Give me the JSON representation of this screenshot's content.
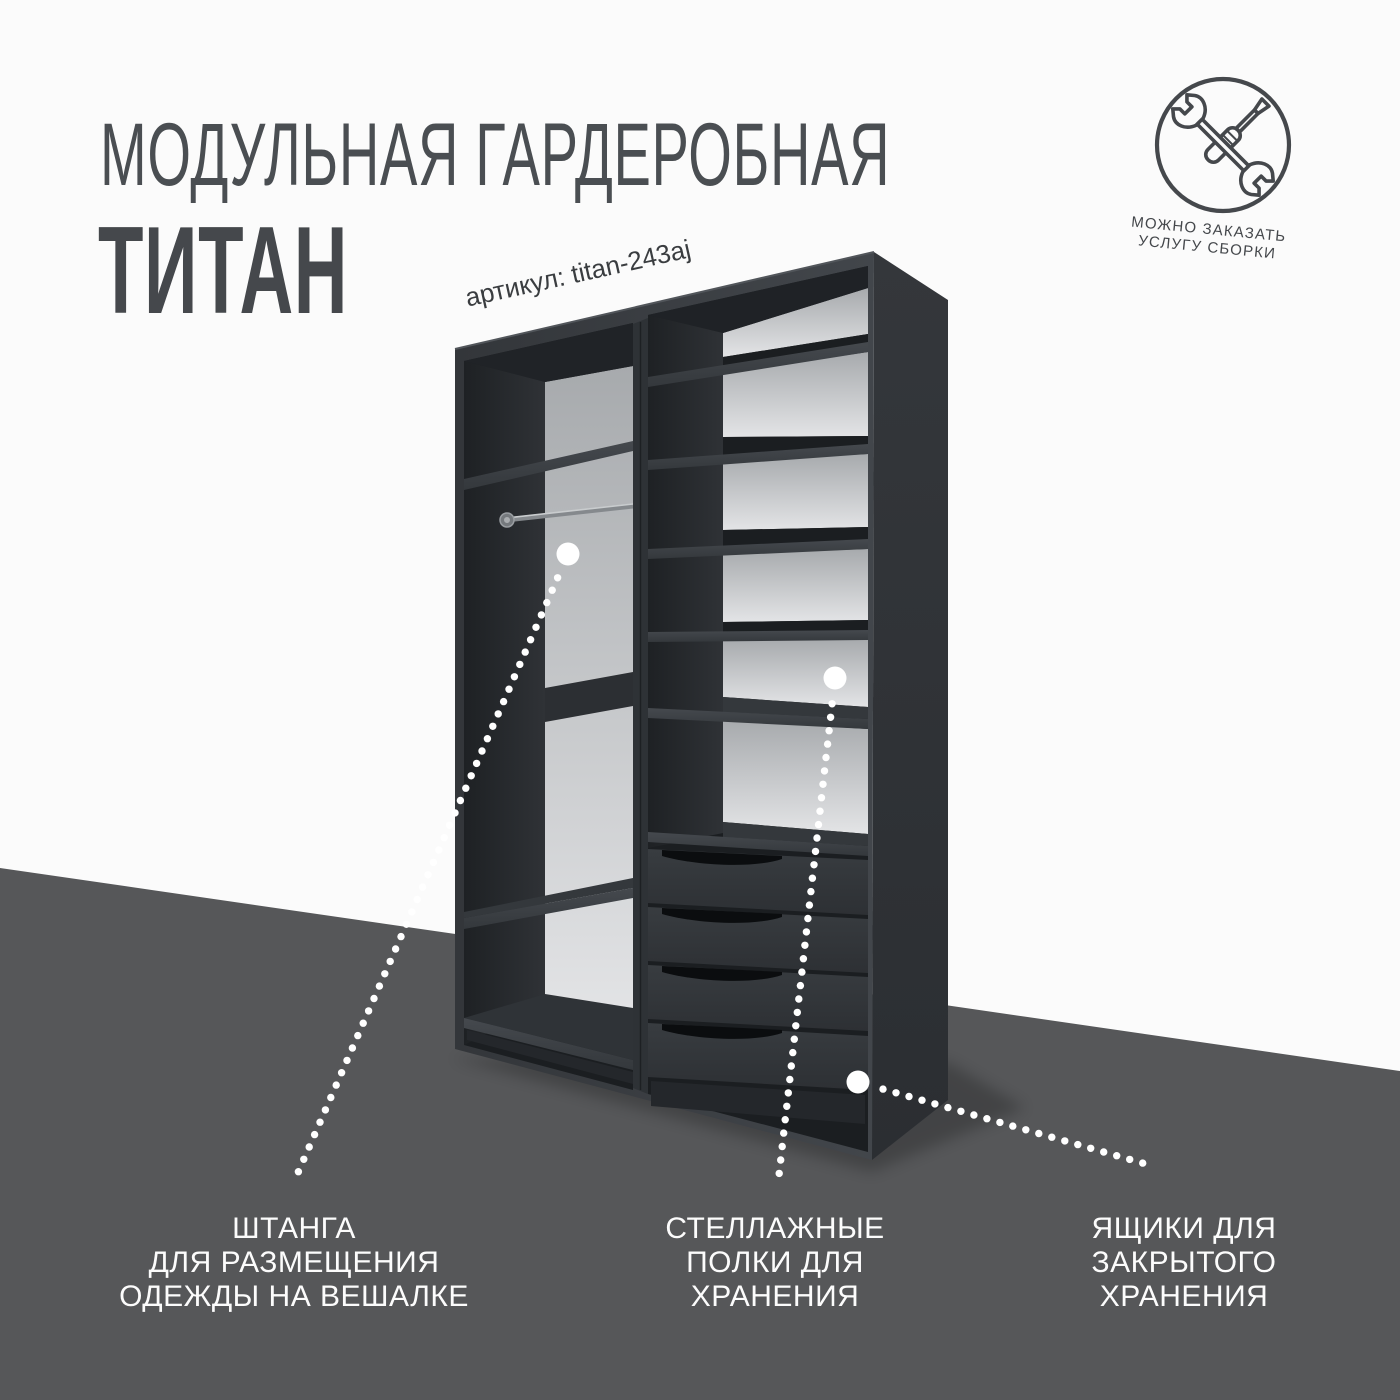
{
  "header": {
    "title_line1": "МОДУЛЬНАЯ ГАРДЕРОБНАЯ",
    "title_line2": "ТИТАН"
  },
  "sku": {
    "label": "артикул: titan-243aj"
  },
  "assembly_badge": {
    "icon": "wrench-screwdriver-icon",
    "caption_line1": "МОЖНО ЗАКАЗАТЬ",
    "caption_line2": "УСЛУГУ СБОРКИ"
  },
  "callouts": [
    {
      "id": "hanging-rod",
      "lines": [
        "ШТАНГА",
        "ДЛЯ РАЗМЕЩЕНИЯ",
        "ОДЕЖДЫ НА ВЕШАЛКЕ"
      ]
    },
    {
      "id": "shelves",
      "lines": [
        "СТЕЛЛАЖНЫЕ",
        "ПОЛКИ ДЛЯ",
        "ХРАНЕНИЯ"
      ]
    },
    {
      "id": "drawers",
      "lines": [
        "ЯЩИКИ ДЛЯ",
        "ЗАКРЫТОГО",
        "ХРАНЕНИЯ"
      ]
    }
  ],
  "colors": {
    "background": "#fbfbfb",
    "floor": "#565759",
    "title_text": "#4a4e52",
    "sku_text": "#3a3d40",
    "badge_line_art": "#45484c",
    "callout_text": "#fcfcfc",
    "wardrobe_front": "#3a3e42",
    "wardrobe_side": "#2f3236",
    "back_panel_light": "#d9dbdd",
    "marker_dots": "#ffffff"
  }
}
